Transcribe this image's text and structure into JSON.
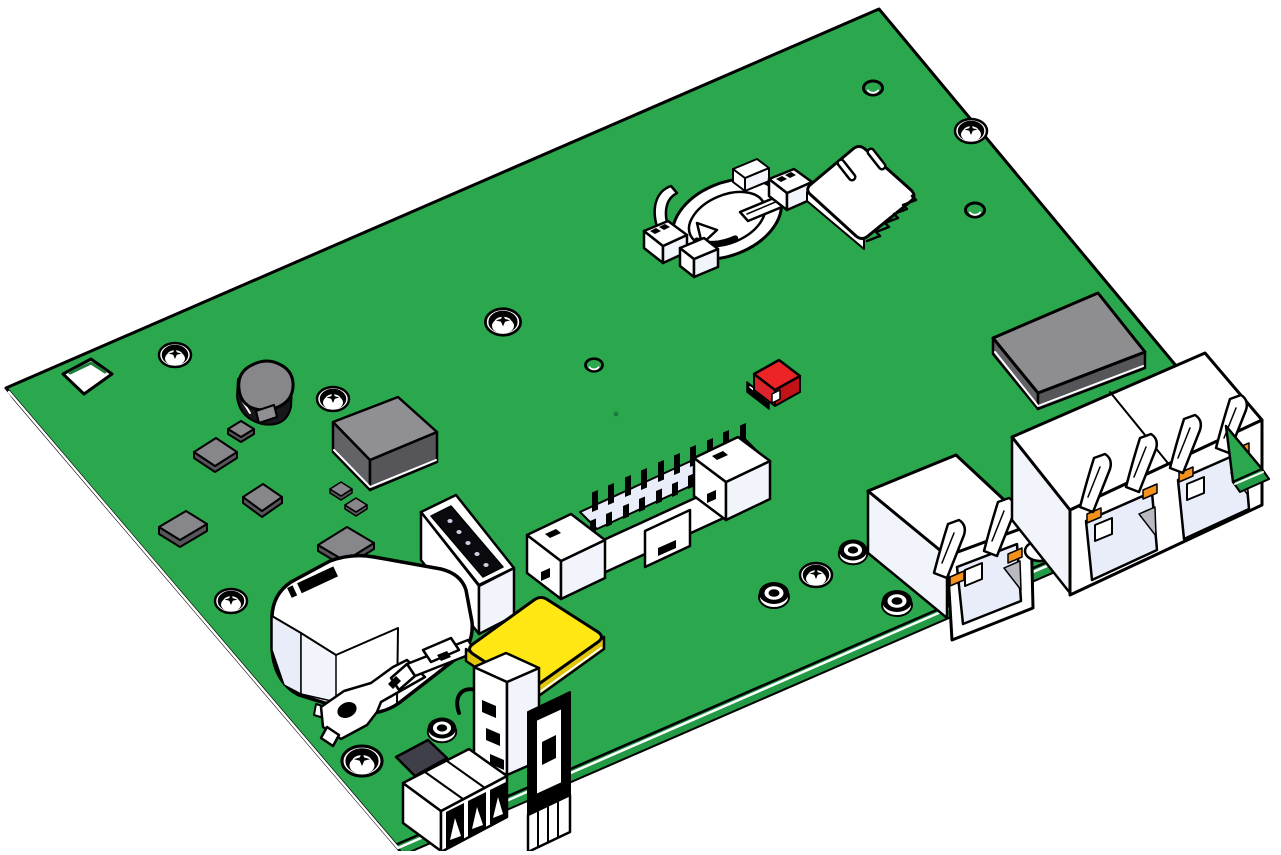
{
  "meta": {
    "title": "Green PCB — 3D CAD isometric rendering",
    "description": "Line-art CAD view of a green printed circuit board populated with connectors and components, viewed isometrically on a white background"
  },
  "canvas": {
    "width": 1281,
    "height": 851
  },
  "colors": {
    "board_green": "#2BA84E",
    "board_edge_green": "#229A46",
    "hole_inner_green": "#1D7C3A",
    "outline": "#000000",
    "component_white": "#FFFFFF",
    "shade_lavender": "#E9ECF9",
    "shade_lavender_light": "#F2F4FC",
    "chip_gray": "#87878B",
    "chip_gray_light": "#909094",
    "chip_gray_dark": "#55555A",
    "module_gray": "#8E8E90",
    "module_gray_side": "#636367",
    "inductor_black": "#17171B",
    "red_top": "#EC2428",
    "red_side": "#C11218",
    "red_side_light": "#D8242A",
    "yellow_top": "#FFE713",
    "yellow_side": "#E0C508",
    "orange_led": "#F5921E",
    "dark_slot": "#0A0A0E",
    "terminal_gray": "#3F3F49",
    "recess_gray": "#B9B9BF"
  },
  "components": [
    {
      "id": "pcb-board",
      "label": "Green PCB main board"
    },
    {
      "id": "board-edge",
      "label": "PCB edge (board thickness)"
    },
    {
      "id": "corner-cutout",
      "label": "Square cutout hole"
    },
    {
      "id": "mounting-screws",
      "label": "Mounting screw holes"
    },
    {
      "id": "vias",
      "label": "Vias"
    },
    {
      "id": "plated-holes",
      "label": "Plated through-holes"
    },
    {
      "id": "smd-chips",
      "label": "SMD chips"
    },
    {
      "id": "main-ic-chip",
      "label": "Main IC chip"
    },
    {
      "id": "power-inductor",
      "label": "Power inductor"
    },
    {
      "id": "shield-module",
      "label": "Shielded module"
    },
    {
      "id": "red-jumper",
      "label": "Red jumper block"
    },
    {
      "id": "battery-holder",
      "label": "Coin cell battery holder"
    },
    {
      "id": "sim-card-slot",
      "label": "Micro SIM card slot"
    },
    {
      "id": "box-pin-header",
      "label": "Boxed pin header (IDC)"
    },
    {
      "id": "pin-socket",
      "label": "Pin socket connector"
    },
    {
      "id": "buzzer",
      "label": "Buzzer / encapsulated component with barcode marking"
    },
    {
      "id": "metal-bracket",
      "label": "Metal bracket"
    },
    {
      "id": "coax-pigtail",
      "label": "Coax pigtail / probe"
    },
    {
      "id": "yellow-chip",
      "label": "Yellow IC module"
    },
    {
      "id": "usb-connector",
      "label": "USB-A connector (vertical)"
    },
    {
      "id": "terminal-block",
      "label": "3-pin terminal block"
    },
    {
      "id": "rj45-single",
      "label": "RJ45 jack (single)"
    },
    {
      "id": "rf-connector",
      "label": "Small RF connector"
    },
    {
      "id": "rj45-dual",
      "label": "RJ45 jack (dual)"
    },
    {
      "id": "board-corner",
      "label": "Board right corner"
    }
  ]
}
